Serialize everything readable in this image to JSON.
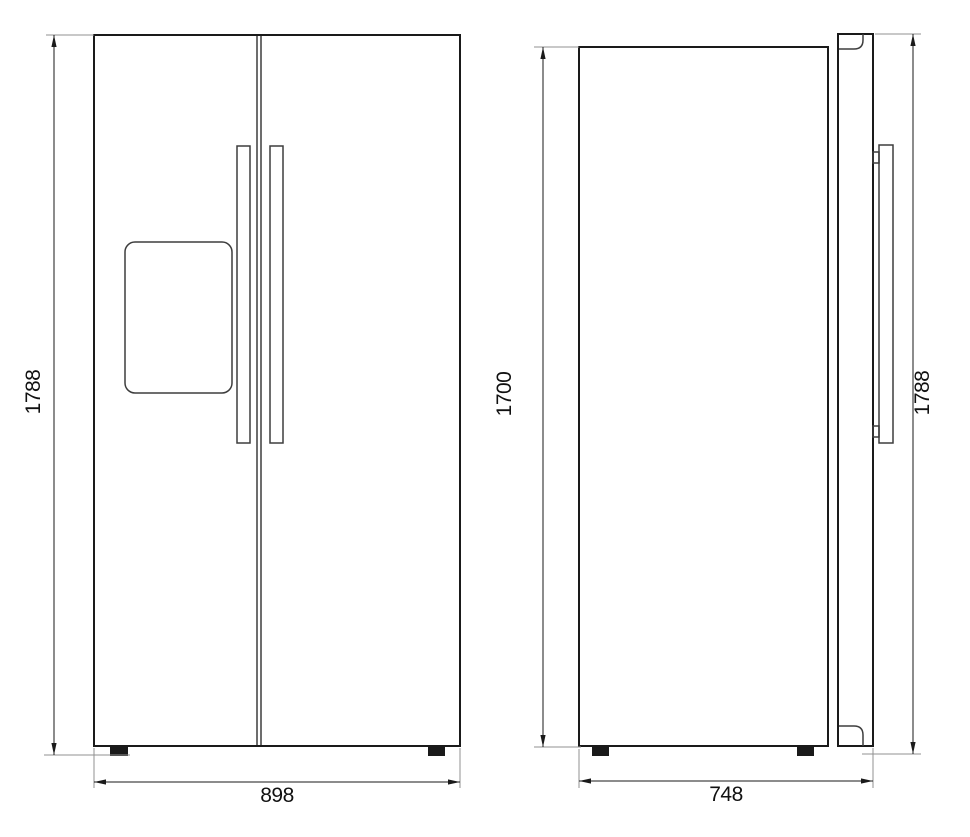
{
  "drawing": {
    "front_view": {
      "dimensions": {
        "overall_height": "1788",
        "overall_width": "898"
      }
    },
    "side_view": {
      "dimensions": {
        "cabinet_height": "1700",
        "cabinet_depth": "748",
        "overall_height": "1788"
      }
    },
    "colors": {
      "outline": "#1a1a1a",
      "detail": "#3d3d3d",
      "extension_line": "#919191",
      "dimension_text": "#111111",
      "background": "#ffffff"
    }
  }
}
